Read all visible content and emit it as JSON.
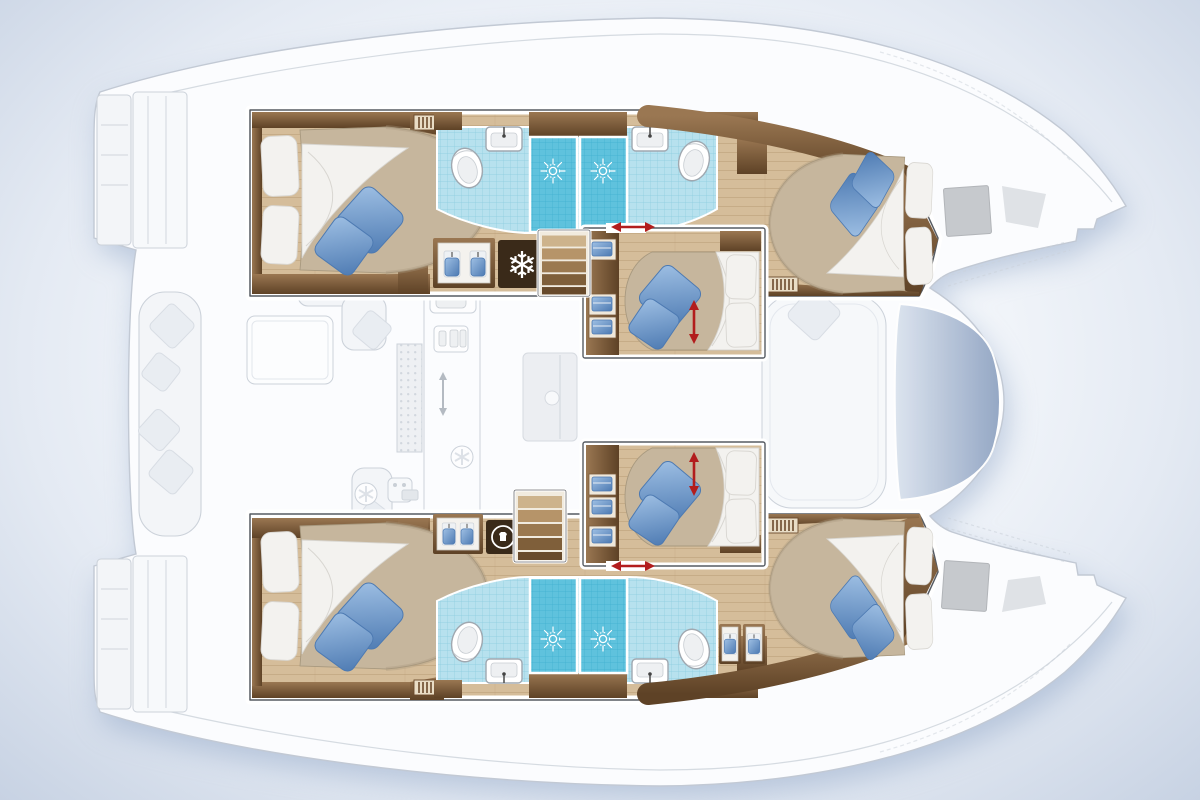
{
  "meta": {
    "description": "Top-down accommodation layout plan of a six-cabin sailing catamaran; lower-deck cabins drawn in full colour, exterior decks and salon ghosted in grey",
    "view": "deck plan, bows pointing right",
    "visible_text": []
  },
  "glyphs": {
    "snowflake": "❄"
  },
  "inventory": {
    "double_bed_cabins": 6,
    "blue_throw_pillows_per_bed": 2,
    "shower_stalls": 4,
    "toilets": 4,
    "washbasins": 4,
    "companionway_stairs": 2,
    "hanging_lockers": 4,
    "vent_grilles": 4,
    "red_direction_arrows": 4,
    "bow_deck_hatches": 2
  },
  "zones": {
    "top_hull": {
      "rooms": [
        "aft-double-cabin",
        "bathroom-two-washbasins-two-toilets",
        "twin-shower-stalls",
        "corridor",
        "forward-double-cabin"
      ],
      "equipment": [
        "hanging-locker",
        "freezer-box-with-snowflake",
        "companionway-stairs",
        "vent-grille"
      ]
    },
    "bottom_hull": {
      "rooms": [
        "aft-double-cabin",
        "bathroom-two-washbasins-two-toilets",
        "twin-shower-stalls",
        "corridor",
        "forward-double-cabin"
      ],
      "equipment": [
        "hanging-locker",
        "washing-machine-box",
        "companionway-stairs",
        "vent-grille",
        "two-forward-hanging-lockers"
      ]
    },
    "bridgedeck": {
      "rooms": [
        "upper-middle-double-cabin",
        "lower-middle-double-cabin"
      ],
      "ghosted_areas": [
        "aft-cockpit-bench-with-pillows",
        "cockpit-table",
        "galley-counter-sink-stove",
        "salon-table",
        "forward-seating",
        "forward-cockpit-well",
        "stern-swim-platforms",
        "bow-decks"
      ]
    }
  },
  "colors": {
    "bg_edge": "#c7d2e3",
    "shadow": "#8fa5c6",
    "deck": "#fbfcfe",
    "deck_line": "#c2c9d4",
    "ghost_fill": "#f3f5f8",
    "ghost_line": "#ccd2da",
    "ghost_soft": "#e9edf2",
    "wood": "#d5bd9a",
    "wood_line": "#b99e77",
    "joinery_dark": "#5e4226",
    "joinery_light": "#9a7752",
    "mattress": "#c6b69d",
    "mattress_shade": "#a8997f",
    "linen": "#f3f2ef",
    "linen_shade": "#d8d6d1",
    "cushion_blue": "#7ba2d3",
    "cushion_blue_dark": "#4d7ab2",
    "cushion_blue_light": "#9fc0e4",
    "tile": "#b7e1ee",
    "tile_line": "#8cccdf",
    "shower": "#5fc2dd",
    "shower_line": "#3fb0cf",
    "fixture_line": "#a0a8b0",
    "icon_box": "#3a2a19",
    "arrow_red": "#b21d1d",
    "hatch_gray": "#c6c9cd",
    "window_light": "#dbe3ee",
    "window_dark": "#8fa3c2",
    "frame_line": "#565b62"
  }
}
